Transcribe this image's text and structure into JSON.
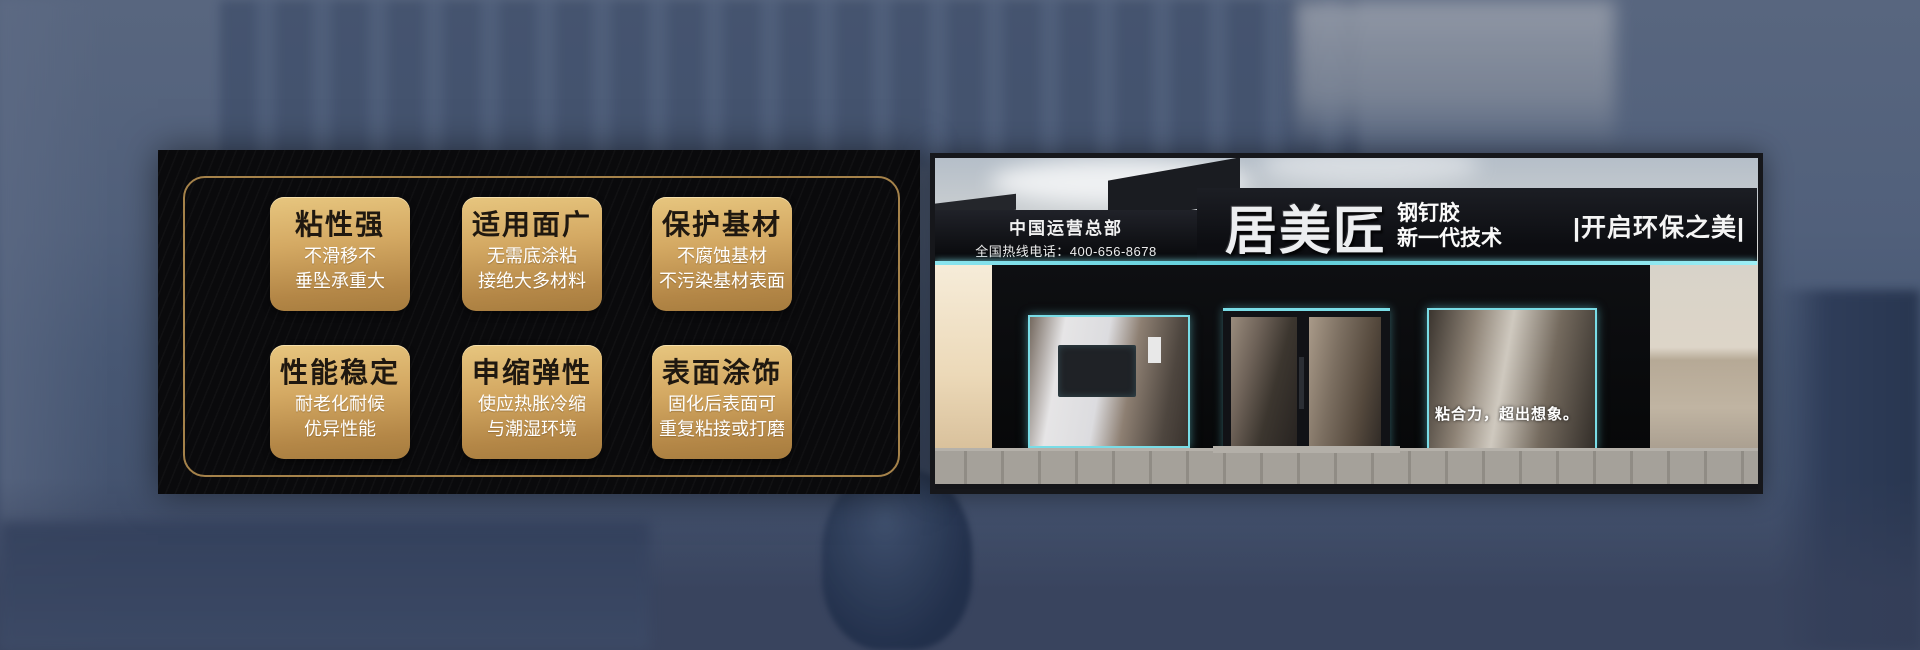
{
  "colors": {
    "panel_bg": "#0a0a0c",
    "gold_border": "#a5824a",
    "card_gold_top": "#e7c67f",
    "card_gold_bottom": "#a67c3e",
    "card_title_text": "#1f1810",
    "card_subtitle_text": "#ffffff",
    "teal_neon": "#7adde7",
    "sign_bg": "#0c0d11",
    "sign_text": "#f2f2f2",
    "background_blue": "#4c5b77"
  },
  "feature_panel": {
    "cards": [
      {
        "title": "粘性强",
        "line1": "不滑移不",
        "line2": "垂坠承重大"
      },
      {
        "title": "适用面广",
        "line1": "无需底涂粘",
        "line2": "接绝大多材料"
      },
      {
        "title": "保护基材",
        "line1": "不腐蚀基材",
        "line2": "不污染基材表面"
      },
      {
        "title": "性能稳定",
        "line1": "耐老化耐候",
        "line2": "优异性能"
      },
      {
        "title": "申缩弹性",
        "line1": "使应热胀冷缩",
        "line2": "与潮湿环境"
      },
      {
        "title": "表面涂饰",
        "line1": "固化后表面可",
        "line2": "重复粘接或打磨"
      }
    ]
  },
  "storefront": {
    "sign_left": {
      "line1": "中国运营总部",
      "line2": "全国热线电话：400-656-8678"
    },
    "sign_main": {
      "brand": "居美匠",
      "product": "钢钉胶",
      "tech": "新一代技术",
      "slogan": "|开启环保之美|"
    },
    "window_slogan": "粘合力，超出想象。"
  }
}
